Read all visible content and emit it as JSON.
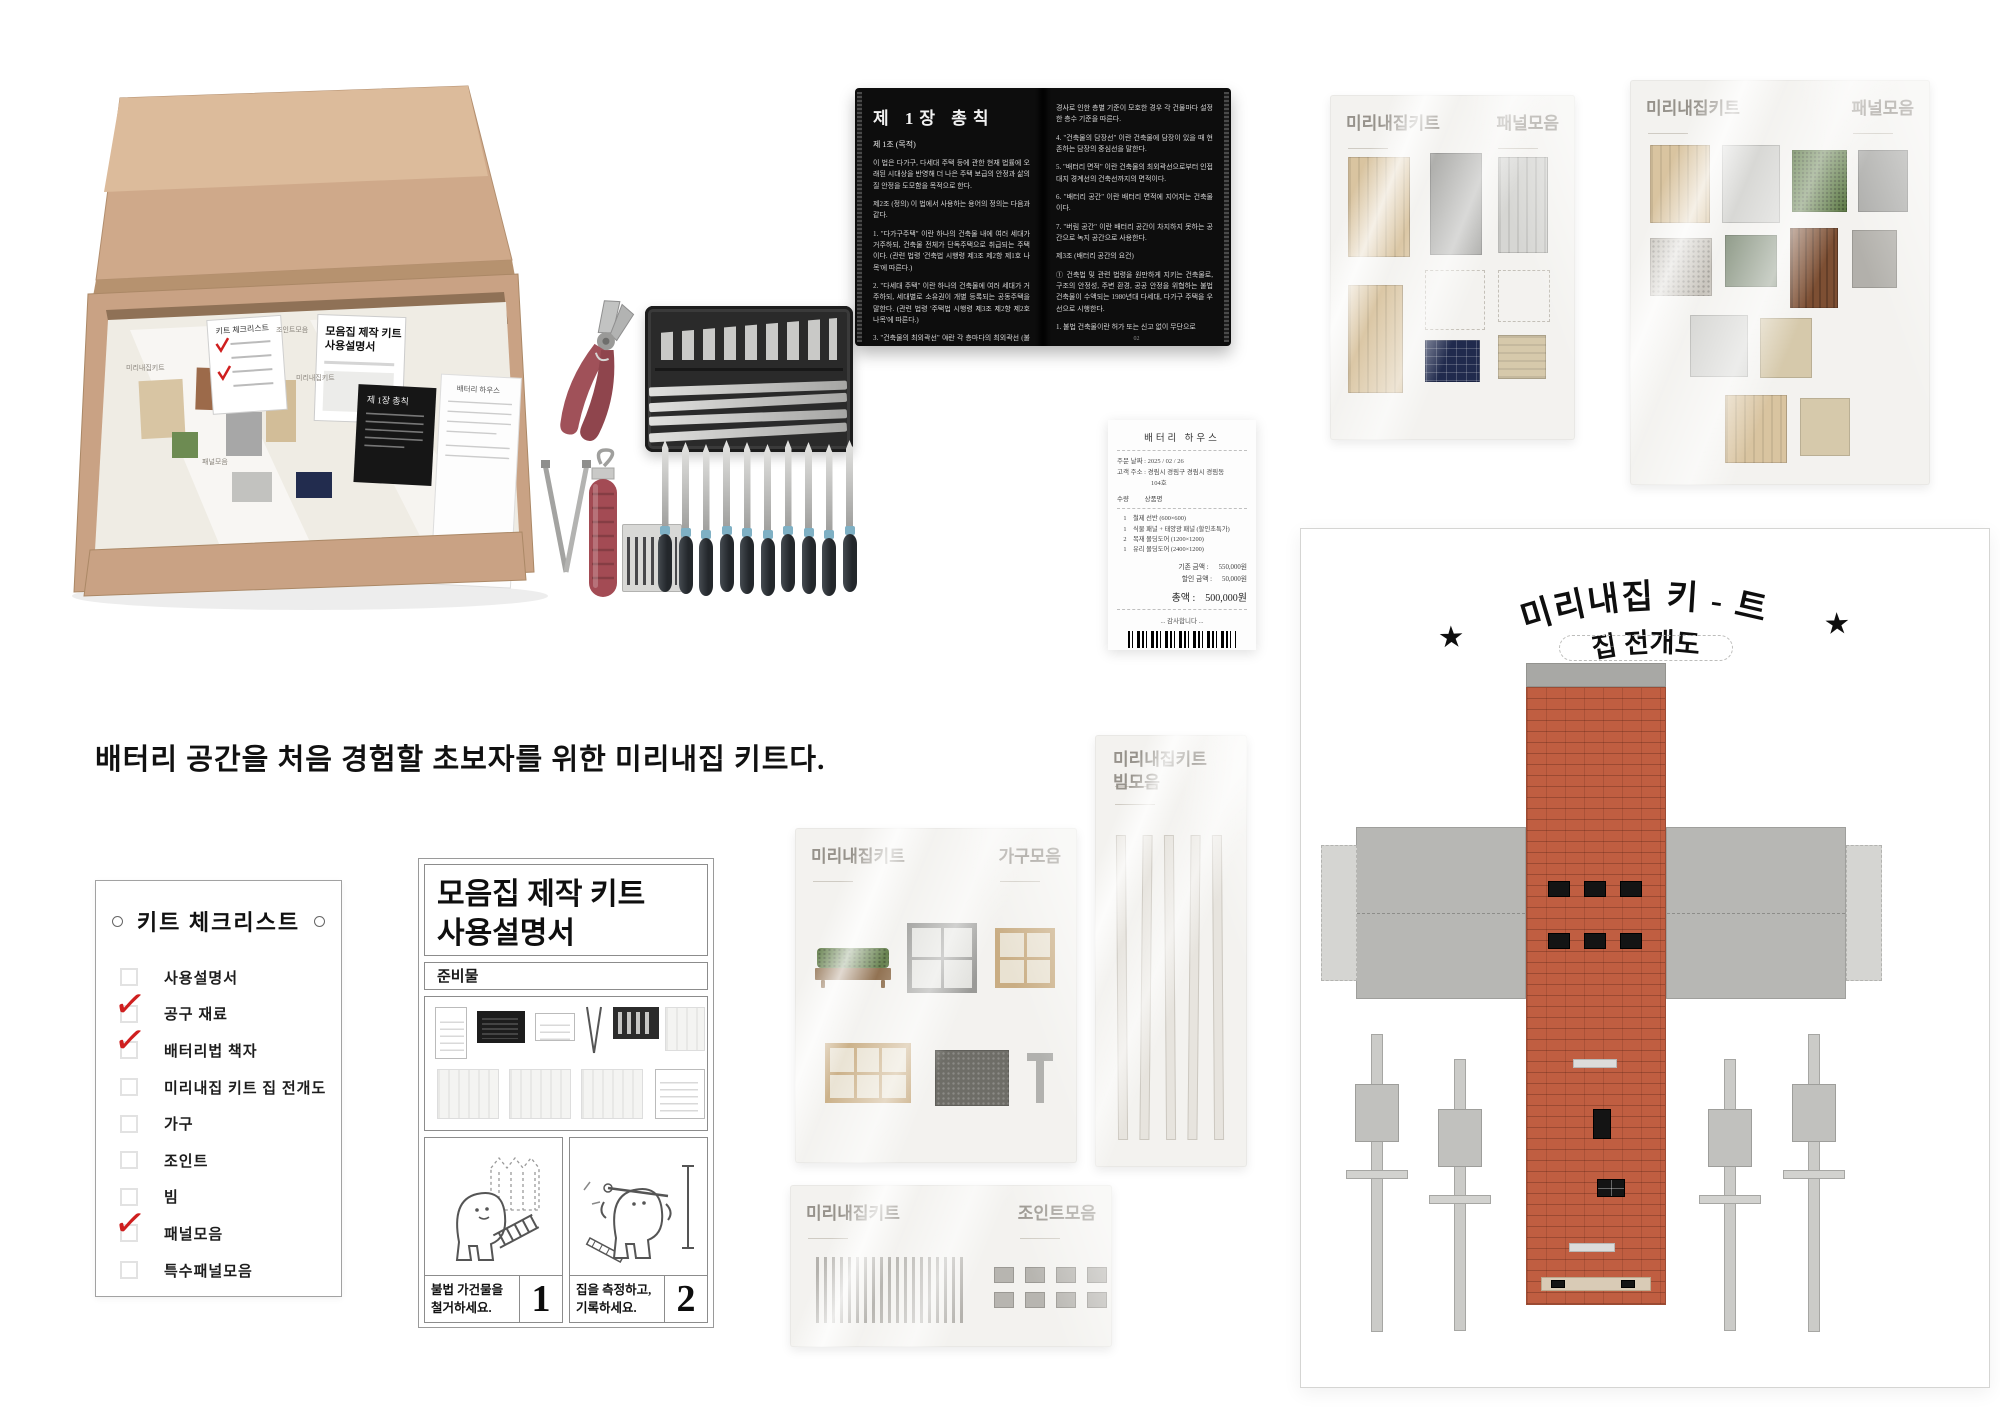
{
  "caption": "배터리 공간을 처음 경험할 초보자를 위한 미리내집 키트다.",
  "box": {
    "mini_labels": [
      "미리내집키트",
      "조인트모음",
      "패널모음",
      "미리내집키트"
    ],
    "mini_manual_line1": "모음집 제작 키트",
    "mini_manual_line2": "사용설명서",
    "mini_checklist_title": "키트 체크리스트",
    "mini_book_title": "제 1장 총칙"
  },
  "book": {
    "left": {
      "chapter": "제 1장 총칙",
      "article": "제 1조 (목적)",
      "paragraphs": [
        "이 법은 다가구, 다세대 주택 등에 관한 현재 법률에 오래된 시대상을 반영해 더 나은 주택 보급의 안정과 삶의 질 안정을 도모함을 목적으로 한다.",
        "제2조 (정의) 이 법에서 사용하는 용어의 정의는 다음과 같다.",
        "1. \"다가구주택\" 이란 하나의 건축물 내에 여러 세대가 거주하되, 건축물 전체가 단독주택으로 취급되는 주택이다. (관련 법령 '건축법 시행령 제3조 제2항 제1호 나목'에 따른다.)",
        "2. \"다세대 주택\" 이란 하나의 건축물에 여러 세대가 거주하되, 세대별로 소유권이 개별 등록되는 공동주택을 말한다. (관련 법령 '주택법 시행령 제3조 제2항 제2호 나목'에 따른다.)",
        "3. \"건축물의 최외곽선\" 이란 각 층마다의 최외곽선 (불법 건축물을 제외)이다. 대지"
      ],
      "page_no": "01"
    },
    "right": {
      "paragraphs": [
        "경사로 인한 층별 기준이 모호한 경우 각 건물마다 설정한 층수 기준을 따른다.",
        "4. \"건축물의 담장선\" 이란 건축물에 담장이 있을 때 현존하는 담장의 중심선을 말한다.",
        "5. \"배터리 면적\" 이란 건축물의 최외곽선으로부터 인접 대지 경계선의 건축선까지의 면적이다.",
        "6. \"배터리 공간\" 이란 배터리 면적에 지어지는 건축물이다.",
        "7. \"버림 공간\" 이란 배터리 공간이 차지하지 못하는 공간으로 녹지 공간으로 사용한다.",
        "제3조 (배터리 공간의 요건)",
        "① 건축법 및 관련 법령을 원만하게 지키는 건축물로, 구조의 안정성, 주변 환경, 공공 안정을 위협하는 불법 건축물이 수액되는 1980년대 다세대, 다가구 주택을 우선으로 시행한다.",
        "1. 불법 건축물이란 허가 또는 신고 없이 무단으로"
      ],
      "page_no": "02"
    }
  },
  "receipt": {
    "store": "배터리 하우스",
    "order_date_label": "주문 날짜 :",
    "order_date": "2025 / 02 / 26",
    "address_label": "고객 주소 :",
    "address_line1": "경림시 경림구 경림시 경림동",
    "address_line2": "104호",
    "qty_header": "수량",
    "item_header": "상품명",
    "items": [
      {
        "qty": "1",
        "name": "철제 선반 (600×600)"
      },
      {
        "qty": "1",
        "name": "식물 패널 + 태양광 패널 (할인초특가)"
      },
      {
        "qty": "2",
        "name": "목재 몰딩도어 (1200×1200)"
      },
      {
        "qty": "1",
        "name": "유리 몰딩도어 (2400×1200)"
      }
    ],
    "subtotal_label": "기존 금액 :",
    "subtotal": "550,000원",
    "discount_label": "할인 금액 :",
    "discount": "50,000원",
    "total_label": "총액 :",
    "total": "500,000원",
    "thanks": "... 감사합니다 ..."
  },
  "checklist": {
    "title": "키트 체크리스트",
    "items": [
      {
        "label": "사용설명서",
        "checked": false
      },
      {
        "label": "공구 재료",
        "checked": true
      },
      {
        "label": "배터리법 책자",
        "checked": true
      },
      {
        "label": "미리내집 키트 집 전개도",
        "checked": false
      },
      {
        "label": "가구",
        "checked": false
      },
      {
        "label": "조인트",
        "checked": false
      },
      {
        "label": "빔",
        "checked": false
      },
      {
        "label": "패널모음",
        "checked": true
      },
      {
        "label": "특수패널모음",
        "checked": false
      }
    ]
  },
  "manual": {
    "title_line1": "모음집 제작 키트",
    "title_line2": "사용설명서",
    "section_label": "준비물",
    "steps": [
      {
        "line1": "불법 가건물을",
        "line2": "철거하세요.",
        "number": "1"
      },
      {
        "line1": "집을 측정하고,",
        "line2": "기록하세요.",
        "number": "2"
      }
    ]
  },
  "bags": {
    "panel_a": {
      "brand": "미리내집키트",
      "type": "패널모음"
    },
    "panel_b": {
      "brand": "미리내집키트",
      "type": "패널모음"
    },
    "furniture": {
      "brand": "미리내집키트",
      "type": "가구모음"
    },
    "beam": {
      "brand": "미리내집키트",
      "type": "빔모음"
    },
    "joint": {
      "brand": "미리내집키트",
      "type": "조인트모음"
    },
    "beam_strip_count": 5,
    "joint_square_count": 8
  },
  "template_sheet": {
    "title_arc": "미리내집 키 - 트",
    "subtitle": "집 전개도",
    "star": "★",
    "beam_piece_count": 4
  },
  "tools": {
    "file_count": 10
  },
  "colors": {
    "cardboard": "#c9a284",
    "check_red": "#cf1f1f",
    "brick": "#c05e41",
    "label_gray": "#96928b",
    "solar_navy": "#202a4d",
    "grass_green": "#5d7a45"
  }
}
